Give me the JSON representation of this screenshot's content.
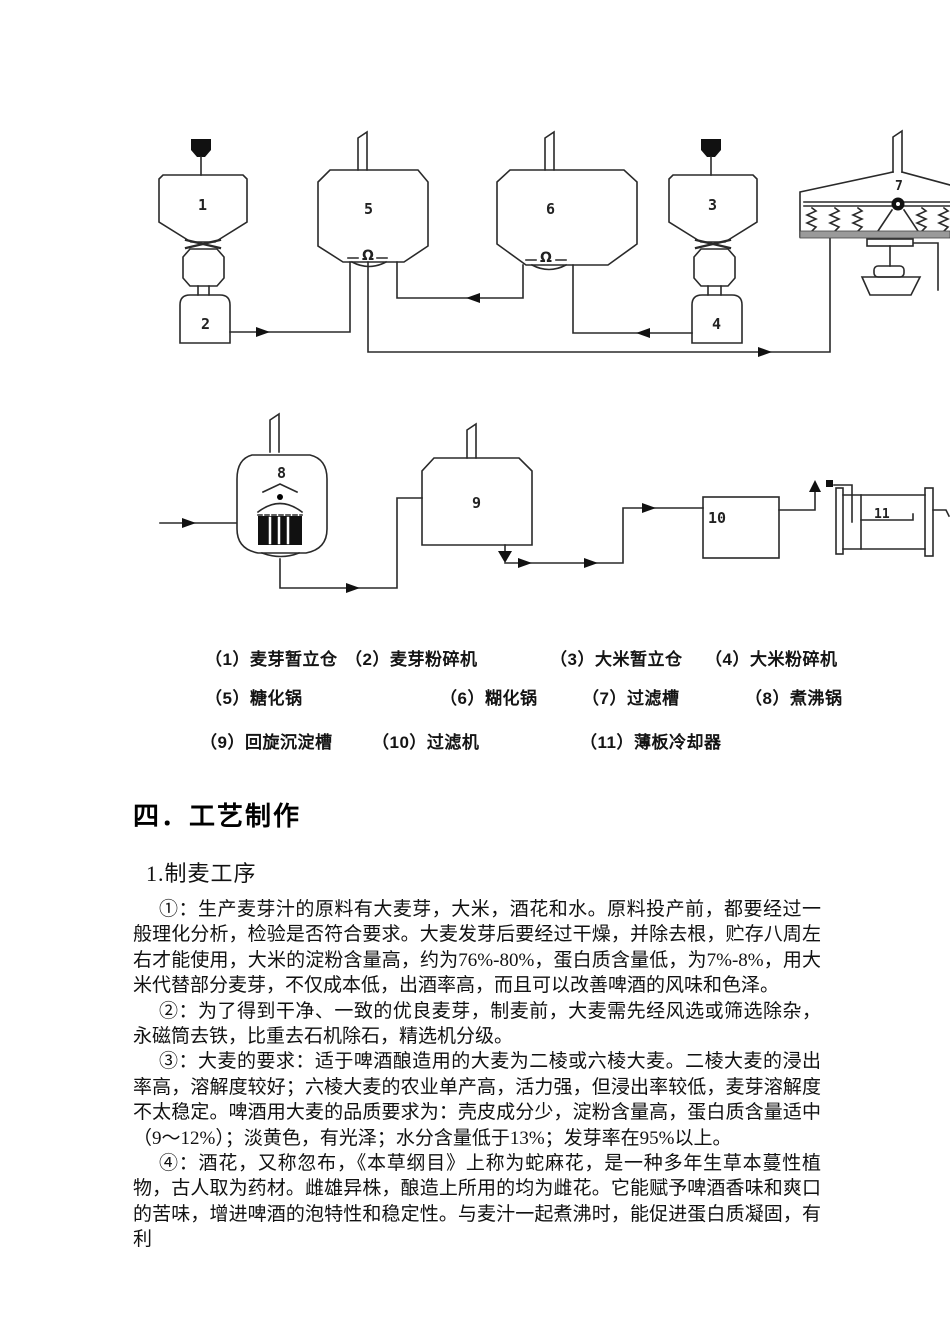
{
  "page": {
    "background": "#ffffff",
    "ink": "#1a1a1a"
  },
  "diagram": {
    "labels": [
      "1",
      "2",
      "3",
      "4",
      "5",
      "6",
      "7",
      "8",
      "9",
      "10",
      "11"
    ],
    "omega": "Ω",
    "legend": [
      "（1）麦芽暂立仓",
      "（2）麦芽粉碎机",
      "（3）大米暂立仓",
      "（4）大米粉碎机",
      "（5）糖化锅",
      "（6）糊化锅",
      "（7）过滤槽",
      "（8）煮沸锅",
      "（9）回旋沉淀槽",
      "（10）过滤机",
      "（11）薄板冷却器"
    ]
  },
  "document": {
    "section_heading": "四．工艺制作",
    "subsection_heading": "1.制麦工序",
    "paragraphs": [
      "①：生产麦芽汁的原料有大麦芽，大米，酒花和水。原料投产前，都要经过一般理化分析，检验是否符合要求。大麦发芽后要经过干燥，并除去根，贮存八周左右才能使用，大米的淀粉含量高，约为76%-80%，蛋白质含量低，为7%-8%，用大米代替部分麦芽，不仅成本低，出酒率高，而且可以改善啤酒的风味和色泽。",
      "②：为了得到干净、一致的优良麦芽，制麦前，大麦需先经风选或筛选除杂，永磁筒去铁，比重去石机除石，精选机分级。",
      "③：大麦的要求：适于啤酒酿造用的大麦为二棱或六棱大麦。二棱大麦的浸出率高，溶解度较好；六棱大麦的农业单产高，活力强，但浸出率较低，麦芽溶解度不太稳定。啤酒用大麦的品质要求为：壳皮成分少，淀粉含量高，蛋白质含量适中（9～12%）；淡黄色，有光泽；水分含量低于13%；发芽率在95%以上。",
      "④：酒花，又称忽布，《本草纲目》上称为蛇麻花，是一种多年生草本蔓性植物，古人取为药材。雌雄异株，酿造上所用的均为雌花。它能赋予啤酒香味和爽口的苦味，增进啤酒的泡特性和稳定性。与麦汁一起煮沸时，能促进蛋白质凝固，有利"
    ]
  }
}
